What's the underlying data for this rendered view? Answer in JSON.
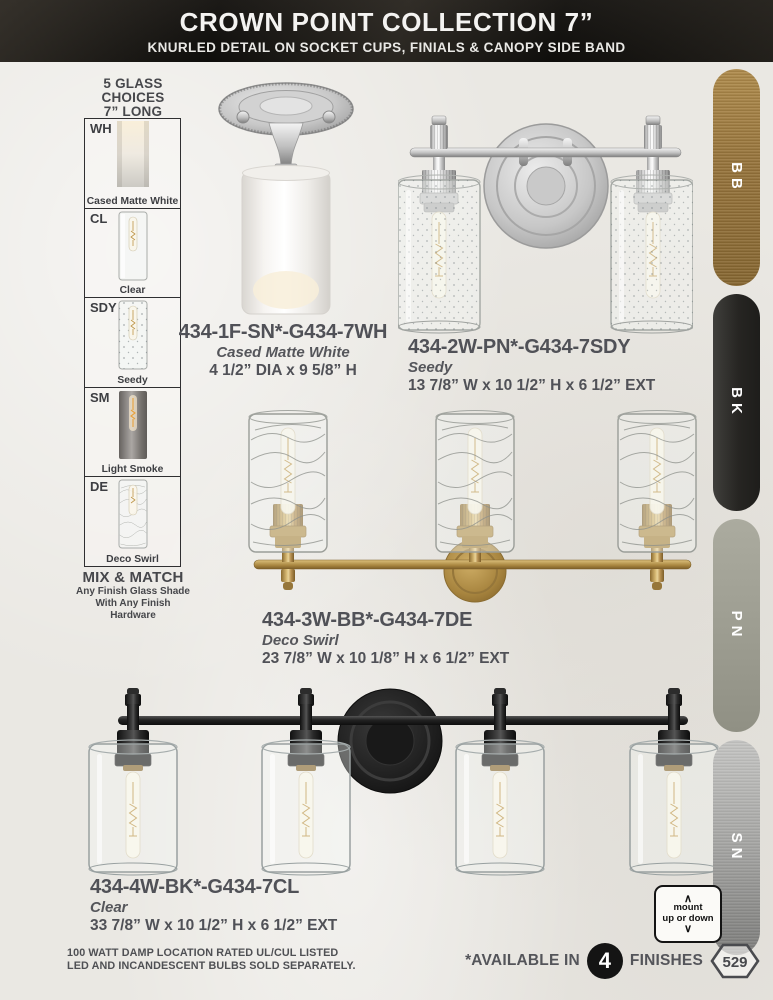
{
  "header": {
    "title": "CROWN POINT COLLECTION 7”",
    "subtitle": "KNURLED DETAIL ON SOCKET CUPS, FINIALS & CANOPY SIDE BAND"
  },
  "glass_choices": {
    "heading_lines": [
      "5 GLASS",
      "CHOICES",
      "7” LONG"
    ],
    "items": [
      {
        "code": "WH",
        "label": "Cased Matte White"
      },
      {
        "code": "CL",
        "label": "Clear"
      },
      {
        "code": "SDY",
        "label": "Seedy"
      },
      {
        "code": "SM",
        "label": "Light Smoke"
      },
      {
        "code": "DE",
        "label": "Deco Swirl"
      }
    ],
    "mix_match_title": "MIX & MATCH",
    "mix_match_lines": [
      "Any Finish Glass Shade",
      "With Any Finish",
      "Hardware"
    ]
  },
  "products": [
    {
      "sku": "434-1F-SN*-G434-7WH",
      "glass": "Cased Matte White",
      "dimensions": "4 1/2” DIA x 9 5/8” H"
    },
    {
      "sku": "434-2W-PN*-G434-7SDY",
      "glass": "Seedy",
      "dimensions": "13 7/8” W x 10 1/2” H x 6 1/2” EXT"
    },
    {
      "sku": "434-3W-BB*-G434-7DE",
      "glass": "Deco Swirl",
      "dimensions": "23 7/8” W x 10 1/8” H x 6 1/2” EXT"
    },
    {
      "sku": "434-4W-BK*-G434-7CL",
      "glass": "Clear",
      "dimensions": "33 7/8” W x 10 1/2” H x 6 1/2” EXT"
    }
  ],
  "finishes": [
    {
      "code": "BB",
      "color": "#9d7b40"
    },
    {
      "code": "BK",
      "color": "#2b2a28"
    },
    {
      "code": "PN",
      "color": "#a2a295"
    },
    {
      "code": "SN",
      "color": "#a9a9a7"
    }
  ],
  "mount_badge": {
    "chevron_up": "∧",
    "line1": "mount",
    "line2": "up or down",
    "chevron_down": "∨"
  },
  "footer": {
    "left_line1": "100 WATT DAMP LOCATION RATED UL/CUL LISTED",
    "left_line2": "LED AND INCANDESCENT BULBS SOLD SEPARATELY.",
    "available_prefix": "*AVAILABLE IN",
    "available_count": "4",
    "available_suffix": "FINISHES",
    "page_number": "529"
  }
}
